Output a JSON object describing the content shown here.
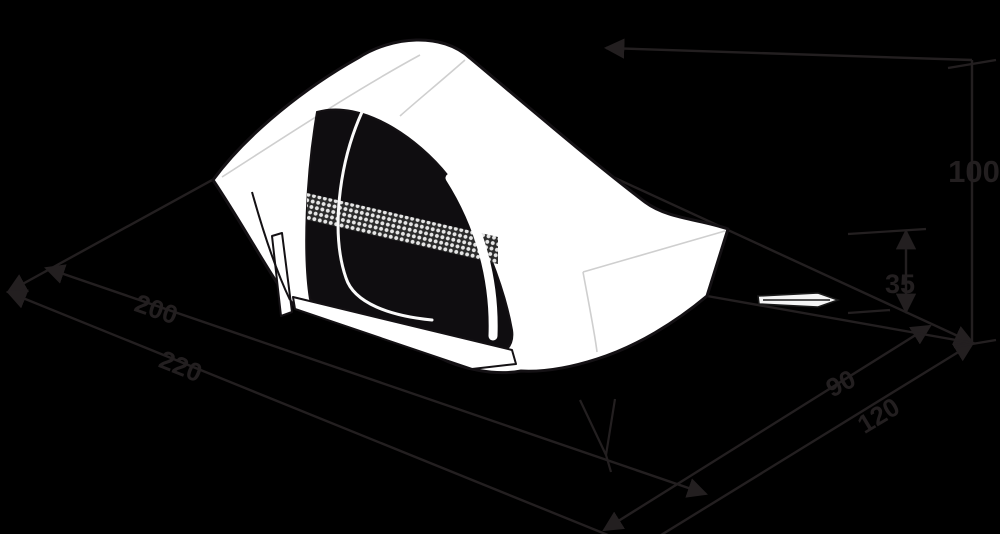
{
  "diagram": {
    "description": "Isometric technical line drawing of a one-person tent with dimension annotations on a black background",
    "background_color": "#000000",
    "annotation_color": "#231f20",
    "tent": {
      "fly_color": "#ffffff",
      "outline_color": "#141114",
      "door_interior_color": "#0f0d10",
      "mesh_dot_color": "#e6e6e6",
      "guyline_color": "#f5f5f5"
    },
    "dimensions": {
      "height": "100",
      "rear_height": "35",
      "outer_length": "220",
      "inner_length": "200",
      "outer_width": "120",
      "inner_width": "90"
    }
  }
}
